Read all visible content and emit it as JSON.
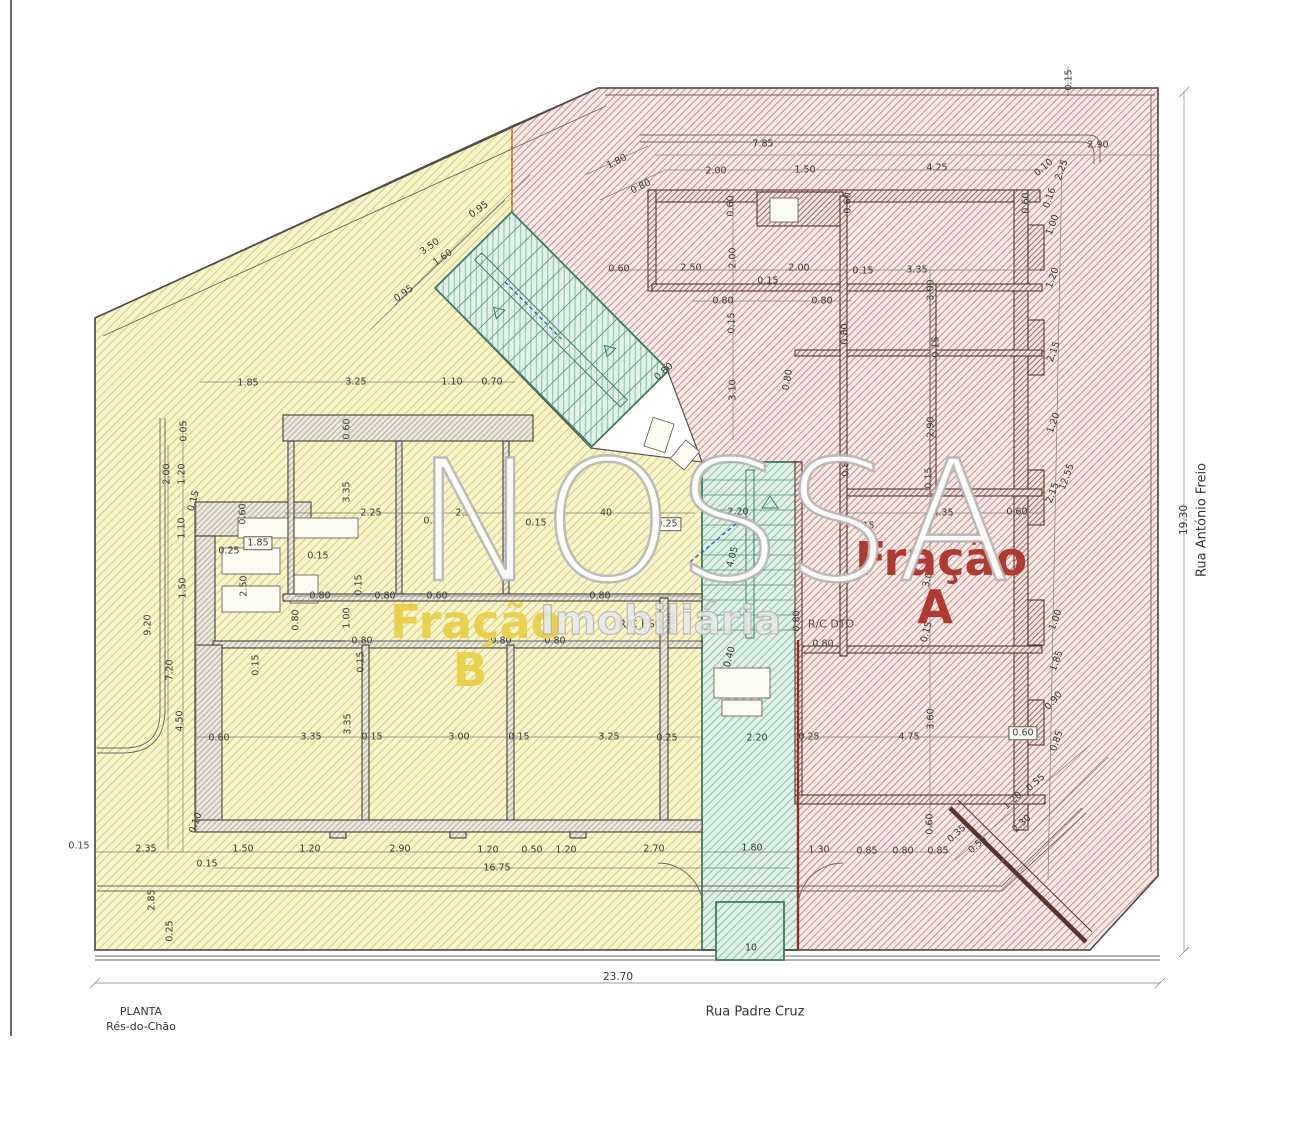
{
  "title": {
    "drawing_type": "PLANTA",
    "floor": "Rés-do-Chão"
  },
  "streets": {
    "bottom": "Rua Padre Cruz",
    "right": "Rua António Freio"
  },
  "overall_dimensions": {
    "width_m": "23.70",
    "height_m": "19.30"
  },
  "fractions": {
    "a": {
      "word": "Fração",
      "letter": "A",
      "color": "#b03a31"
    },
    "b": {
      "word": "Fração",
      "letter": "B",
      "color": "#e7d14f"
    }
  },
  "units": {
    "left_unit": "R/C ESQ",
    "right_unit": "R/C DTO"
  },
  "watermark": {
    "name": "NOSSA",
    "subtitle": "Imobiliária"
  },
  "colors": {
    "paper": "#ffffff",
    "dim_text": "#3c3c3c",
    "yellow_fill": "#f8f4d2",
    "yellow_line": "#ddd06a",
    "red_fill": "#f7eae7",
    "red_line": "#c3807e",
    "teal_fill": "#e3f2e9",
    "teal_line": "#85bfa6",
    "wall_gray": "#b9b2a4",
    "wall_red": "#9c6b63",
    "fraction_a": "#b03a31",
    "fraction_b": "#e7d14f",
    "boundary_dashed": "#d98f3e"
  },
  "dimension_labels": [
    {
      "t": "7.85",
      "x": 763,
      "y": 144,
      "r": 0
    },
    {
      "t": "2.90",
      "x": 1098,
      "y": 145,
      "r": 0
    },
    {
      "t": "1.80",
      "x": 617,
      "y": 162,
      "r": -27
    },
    {
      "t": "0.80",
      "x": 641,
      "y": 187,
      "r": -27
    },
    {
      "t": "2.00",
      "x": 716,
      "y": 171,
      "r": 0
    },
    {
      "t": "1.50",
      "x": 805,
      "y": 170,
      "r": 0
    },
    {
      "t": "4.25",
      "x": 937,
      "y": 168,
      "r": 0
    },
    {
      "t": "0.10",
      "x": 1044,
      "y": 168,
      "r": -40
    },
    {
      "t": "0.15",
      "x": 1069,
      "y": 80,
      "r": -90
    },
    {
      "t": "2.25",
      "x": 1062,
      "y": 170,
      "r": -70
    },
    {
      "t": "0.16",
      "x": 1050,
      "y": 198,
      "r": -70
    },
    {
      "t": "1.00",
      "x": 1053,
      "y": 225,
      "r": -70
    },
    {
      "t": "1.20",
      "x": 1053,
      "y": 278,
      "r": -70
    },
    {
      "t": "2.15",
      "x": 1054,
      "y": 352,
      "r": -70
    },
    {
      "t": "1.20",
      "x": 1054,
      "y": 423,
      "r": -70
    },
    {
      "t": "12.55",
      "x": 1067,
      "y": 477,
      "r": -70
    },
    {
      "t": "2.15",
      "x": 1053,
      "y": 493,
      "r": -70
    },
    {
      "t": "1.00",
      "x": 1056,
      "y": 620,
      "r": -70
    },
    {
      "t": "1.85",
      "x": 1057,
      "y": 661,
      "r": -70
    },
    {
      "t": "0.90",
      "x": 1054,
      "y": 701,
      "r": -50
    },
    {
      "t": "0.85",
      "x": 1057,
      "y": 741,
      "r": -70
    },
    {
      "t": "0.60",
      "x": 1023,
      "y": 733,
      "r": 0,
      "b": 1
    },
    {
      "t": "0.55",
      "x": 1036,
      "y": 783,
      "r": -42
    },
    {
      "t": "1.20",
      "x": 1013,
      "y": 801,
      "r": -42
    },
    {
      "t": "2.30",
      "x": 1022,
      "y": 824,
      "r": -42
    },
    {
      "t": "0.55",
      "x": 978,
      "y": 845,
      "r": -42
    },
    {
      "t": "0.35",
      "x": 957,
      "y": 834,
      "r": -42
    },
    {
      "t": "0.60",
      "x": 731,
      "y": 206,
      "r": -90
    },
    {
      "t": "0.60",
      "x": 848,
      "y": 203,
      "r": -90
    },
    {
      "t": "0.60",
      "x": 1026,
      "y": 203,
      "r": -90
    },
    {
      "t": "0.60",
      "x": 619,
      "y": 269,
      "r": 0
    },
    {
      "t": "2.50",
      "x": 691,
      "y": 268,
      "r": 0
    },
    {
      "t": "2.00",
      "x": 733,
      "y": 258,
      "r": -90
    },
    {
      "t": "0.15",
      "x": 768,
      "y": 281,
      "r": 0
    },
    {
      "t": "2.00",
      "x": 799,
      "y": 268,
      "r": 0
    },
    {
      "t": "0.15",
      "x": 863,
      "y": 271,
      "r": 0
    },
    {
      "t": "3.35",
      "x": 917,
      "y": 270,
      "r": 0
    },
    {
      "t": "3.00",
      "x": 931,
      "y": 290,
      "r": -90
    },
    {
      "t": "0.80",
      "x": 723,
      "y": 301,
      "r": 0
    },
    {
      "t": "0.80",
      "x": 822,
      "y": 301,
      "r": 0
    },
    {
      "t": "0.80",
      "x": 845,
      "y": 334,
      "r": -90
    },
    {
      "t": "0.15",
      "x": 936,
      "y": 347,
      "r": -90
    },
    {
      "t": "0.15",
      "x": 732,
      "y": 323,
      "r": -90
    },
    {
      "t": "3.10",
      "x": 733,
      "y": 390,
      "r": -90
    },
    {
      "t": "0.80",
      "x": 664,
      "y": 372,
      "r": -40
    },
    {
      "t": "0.80",
      "x": 788,
      "y": 380,
      "r": -80
    },
    {
      "t": "2.90",
      "x": 931,
      "y": 427,
      "r": -90
    },
    {
      "t": "0.15",
      "x": 929,
      "y": 478,
      "r": -90
    },
    {
      "t": "0.80",
      "x": 846,
      "y": 466,
      "r": -90
    },
    {
      "t": "3.35",
      "x": 943,
      "y": 513,
      "r": 0
    },
    {
      "t": "0.60",
      "x": 1017,
      "y": 512,
      "r": 0
    },
    {
      "t": "0.15",
      "x": 864,
      "y": 526,
      "r": 0
    },
    {
      "t": "3.00",
      "x": 929,
      "y": 577,
      "r": -75
    },
    {
      "t": "0.15",
      "x": 927,
      "y": 632,
      "r": -75
    },
    {
      "t": "2.20",
      "x": 738,
      "y": 512,
      "r": 0
    },
    {
      "t": "4.05",
      "x": 733,
      "y": 557,
      "r": -75
    },
    {
      "t": "0.40",
      "x": 730,
      "y": 657,
      "r": -75
    },
    {
      "t": "0.80",
      "x": 797,
      "y": 621,
      "r": -90
    },
    {
      "t": "0.80",
      "x": 823,
      "y": 644,
      "r": 0
    },
    {
      "t": "0.80",
      "x": 672,
      "y": 623,
      "r": -90
    },
    {
      "t": "10",
      "x": 751,
      "y": 948,
      "r": 0
    },
    {
      "t": "1.85",
      "x": 248,
      "y": 383,
      "r": 0
    },
    {
      "t": "3.25",
      "x": 356,
      "y": 382,
      "r": 0
    },
    {
      "t": "1.10",
      "x": 452,
      "y": 382,
      "r": 0
    },
    {
      "t": "0.70",
      "x": 492,
      "y": 382,
      "r": 0
    },
    {
      "t": "0.60",
      "x": 347,
      "y": 429,
      "r": -90
    },
    {
      "t": "3.35",
      "x": 347,
      "y": 492,
      "r": -90
    },
    {
      "t": "0.05",
      "x": 184,
      "y": 431,
      "r": -90
    },
    {
      "t": "2.00",
      "x": 167,
      "y": 474,
      "r": -90
    },
    {
      "t": "1.20",
      "x": 182,
      "y": 474,
      "r": -90
    },
    {
      "t": "0.15",
      "x": 194,
      "y": 501,
      "r": -75
    },
    {
      "t": "1.10",
      "x": 182,
      "y": 528,
      "r": -90
    },
    {
      "t": "2.25",
      "x": 371,
      "y": 513,
      "r": 0
    },
    {
      "t": "0.15",
      "x": 434,
      "y": 521,
      "r": 0
    },
    {
      "t": "2.30",
      "x": 466,
      "y": 513,
      "r": 0
    },
    {
      "t": "0.15",
      "x": 536,
      "y": 523,
      "r": 0
    },
    {
      "t": "40",
      "x": 606,
      "y": 513,
      "r": 0
    },
    {
      "t": "0.25",
      "x": 667,
      "y": 524,
      "r": 0,
      "b": 1
    },
    {
      "t": "0.60",
      "x": 243,
      "y": 514,
      "r": -90
    },
    {
      "t": "1.85",
      "x": 258,
      "y": 543,
      "r": 0,
      "b": 1
    },
    {
      "t": "0.25",
      "x": 229,
      "y": 551,
      "r": 0
    },
    {
      "t": "0.15",
      "x": 318,
      "y": 556,
      "r": 0
    },
    {
      "t": "2.50",
      "x": 244,
      "y": 586,
      "r": -90
    },
    {
      "t": "1.50",
      "x": 183,
      "y": 588,
      "r": -90
    },
    {
      "t": "0.80",
      "x": 296,
      "y": 620,
      "r": -90
    },
    {
      "t": "1.00",
      "x": 347,
      "y": 618,
      "r": -90
    },
    {
      "t": "0.15",
      "x": 359,
      "y": 585,
      "r": -90
    },
    {
      "t": "0.80",
      "x": 320,
      "y": 596,
      "r": 0
    },
    {
      "t": "0.80",
      "x": 385,
      "y": 596,
      "r": 0
    },
    {
      "t": "0.60",
      "x": 437,
      "y": 596,
      "r": 0
    },
    {
      "t": "0.80",
      "x": 600,
      "y": 596,
      "r": 0
    },
    {
      "t": "0.80",
      "x": 362,
      "y": 641,
      "r": 0
    },
    {
      "t": "0.80",
      "x": 501,
      "y": 641,
      "r": 0
    },
    {
      "t": "0.80",
      "x": 555,
      "y": 641,
      "r": 0
    },
    {
      "t": "0.15",
      "x": 256,
      "y": 665,
      "r": -90
    },
    {
      "t": "0.15",
      "x": 361,
      "y": 662,
      "r": -90
    },
    {
      "t": "3.35",
      "x": 348,
      "y": 724,
      "r": -90
    },
    {
      "t": "4.50",
      "x": 180,
      "y": 721,
      "r": -90
    },
    {
      "t": "9.20",
      "x": 148,
      "y": 625,
      "r": -90
    },
    {
      "t": "7.20",
      "x": 170,
      "y": 670,
      "r": -90
    },
    {
      "t": "0.60",
      "x": 219,
      "y": 738,
      "r": 0
    },
    {
      "t": "3.35",
      "x": 311,
      "y": 737,
      "r": 0
    },
    {
      "t": "0.15",
      "x": 372,
      "y": 737,
      "r": 0
    },
    {
      "t": "3.00",
      "x": 459,
      "y": 737,
      "r": 0
    },
    {
      "t": "0.15",
      "x": 519,
      "y": 737,
      "r": 0
    },
    {
      "t": "3.25",
      "x": 609,
      "y": 737,
      "r": 0
    },
    {
      "t": "0.25",
      "x": 667,
      "y": 738,
      "r": 0
    },
    {
      "t": "2.20",
      "x": 757,
      "y": 738,
      "r": 0
    },
    {
      "t": "0.25",
      "x": 809,
      "y": 737,
      "r": 0
    },
    {
      "t": "4.75",
      "x": 909,
      "y": 737,
      "r": 0
    },
    {
      "t": "3.60",
      "x": 931,
      "y": 719,
      "r": -90
    },
    {
      "t": "0.60",
      "x": 930,
      "y": 824,
      "r": -90
    },
    {
      "t": "0.15",
      "x": 79,
      "y": 846,
      "r": 0
    },
    {
      "t": "2.35",
      "x": 146,
      "y": 849,
      "r": 0
    },
    {
      "t": "0.15",
      "x": 207,
      "y": 864,
      "r": 0
    },
    {
      "t": "1.50",
      "x": 243,
      "y": 849,
      "r": 0
    },
    {
      "t": "1.20",
      "x": 310,
      "y": 849,
      "r": 0
    },
    {
      "t": "2.90",
      "x": 400,
      "y": 849,
      "r": 0
    },
    {
      "t": "1.20",
      "x": 488,
      "y": 850,
      "r": 0
    },
    {
      "t": "0.50",
      "x": 532,
      "y": 850,
      "r": 0
    },
    {
      "t": "1.20",
      "x": 566,
      "y": 850,
      "r": 0
    },
    {
      "t": "2.70",
      "x": 654,
      "y": 849,
      "r": 0
    },
    {
      "t": "1.80",
      "x": 752,
      "y": 848,
      "r": 0
    },
    {
      "t": "1.30",
      "x": 819,
      "y": 850,
      "r": 0
    },
    {
      "t": "0.85",
      "x": 867,
      "y": 851,
      "r": 0
    },
    {
      "t": "0.80",
      "x": 903,
      "y": 851,
      "r": 0
    },
    {
      "t": "0.85",
      "x": 938,
      "y": 851,
      "r": 0
    },
    {
      "t": "16.75",
      "x": 497,
      "y": 868,
      "r": 0
    },
    {
      "t": "0.10",
      "x": 196,
      "y": 823,
      "r": -70
    },
    {
      "t": "2.85",
      "x": 152,
      "y": 900,
      "r": -90
    },
    {
      "t": "0.25",
      "x": 170,
      "y": 931,
      "r": -90
    },
    {
      "t": "0.95",
      "x": 479,
      "y": 210,
      "r": -36
    },
    {
      "t": "3.50",
      "x": 430,
      "y": 247,
      "r": -36
    },
    {
      "t": "1.60",
      "x": 443,
      "y": 258,
      "r": -36
    },
    {
      "t": "0.95",
      "x": 404,
      "y": 294,
      "r": -36
    }
  ]
}
